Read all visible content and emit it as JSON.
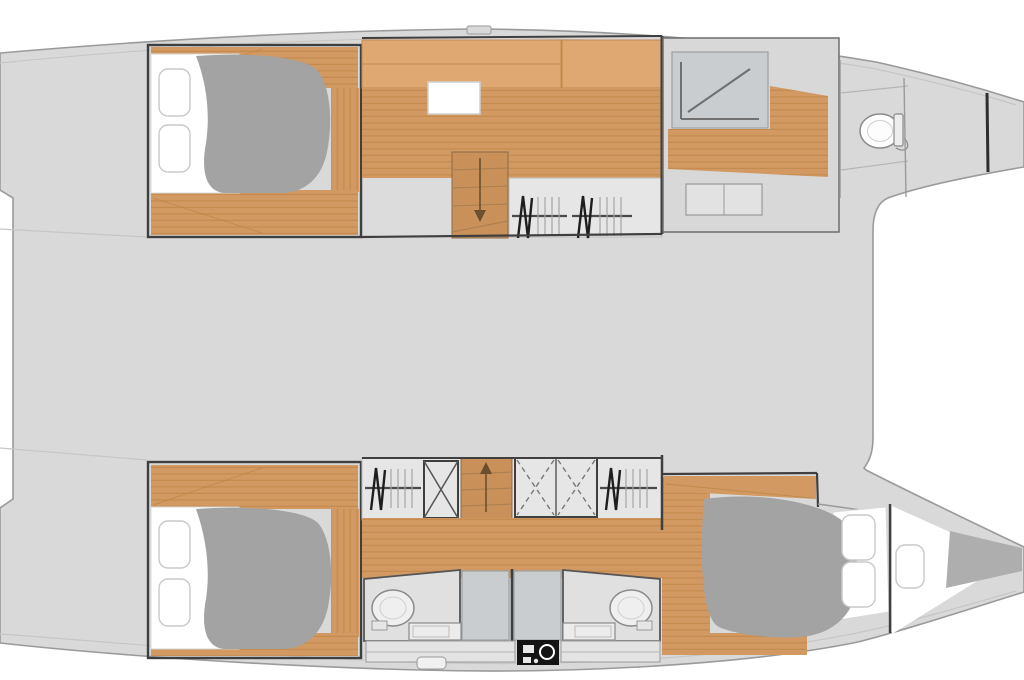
{
  "page": {
    "title": "Catamaran interior layout plan",
    "type": "floor-plan",
    "view": "overhead deck plan",
    "orientation": "bows pointing right"
  },
  "colors": {
    "background": "#ffffff",
    "deck": "#d9d9d9",
    "room_floor": "#dcdcdc",
    "bath_floor": "#e0e0e0",
    "locker_floor": "#e6e6e6",
    "wood": "#d29a62",
    "wood_dark": "#b9813f",
    "cabinet": "#dfa873",
    "stairs": "#c9905a",
    "duvet": "#a3a3a3",
    "cushion": "#aeaeae",
    "mattress": "#ffffff",
    "shower": "#c9cdd0",
    "platform": "#e3e3e3",
    "fixture_black": "#141414",
    "wall": "#3f3f3f",
    "outline": "#9a9a9a"
  },
  "layout": {
    "bridge_deck": "open saloon area, undetailed",
    "upper_hull": {
      "aft_cabin": "owner double berth with two pillows and wood floor surround",
      "midship": "dressing area with cabinets, white deck hatch, companionway stairs down, two hanging lockers",
      "forward": "owner bathroom with corner shower, vanity unit and sea toilet",
      "bow": "forepeak with watertight bulkhead"
    },
    "lower_hull": {
      "aft_cabin": "guest double berth with two pillows and wood floor surround",
      "midship": "hanging lockers, shelved locker with cross braces, companionway stairs up, double locker with cross straps",
      "heads": "two back-to-back bathrooms each with toilet, basin and shower; black galley-style unit between",
      "forward_cabin": "guest double berth with two pillows",
      "bow": "forepeak with cushion and bulkhead"
    }
  },
  "icons": [
    "toilet-icon",
    "corner-shower-icon",
    "hanger-rail-icon",
    "stairs-down-arrow-icon",
    "stairs-up-arrow-icon",
    "cross-brace-locker-icon",
    "sink-icon",
    "galley-unit-icon",
    "deck-hatch-icon"
  ]
}
